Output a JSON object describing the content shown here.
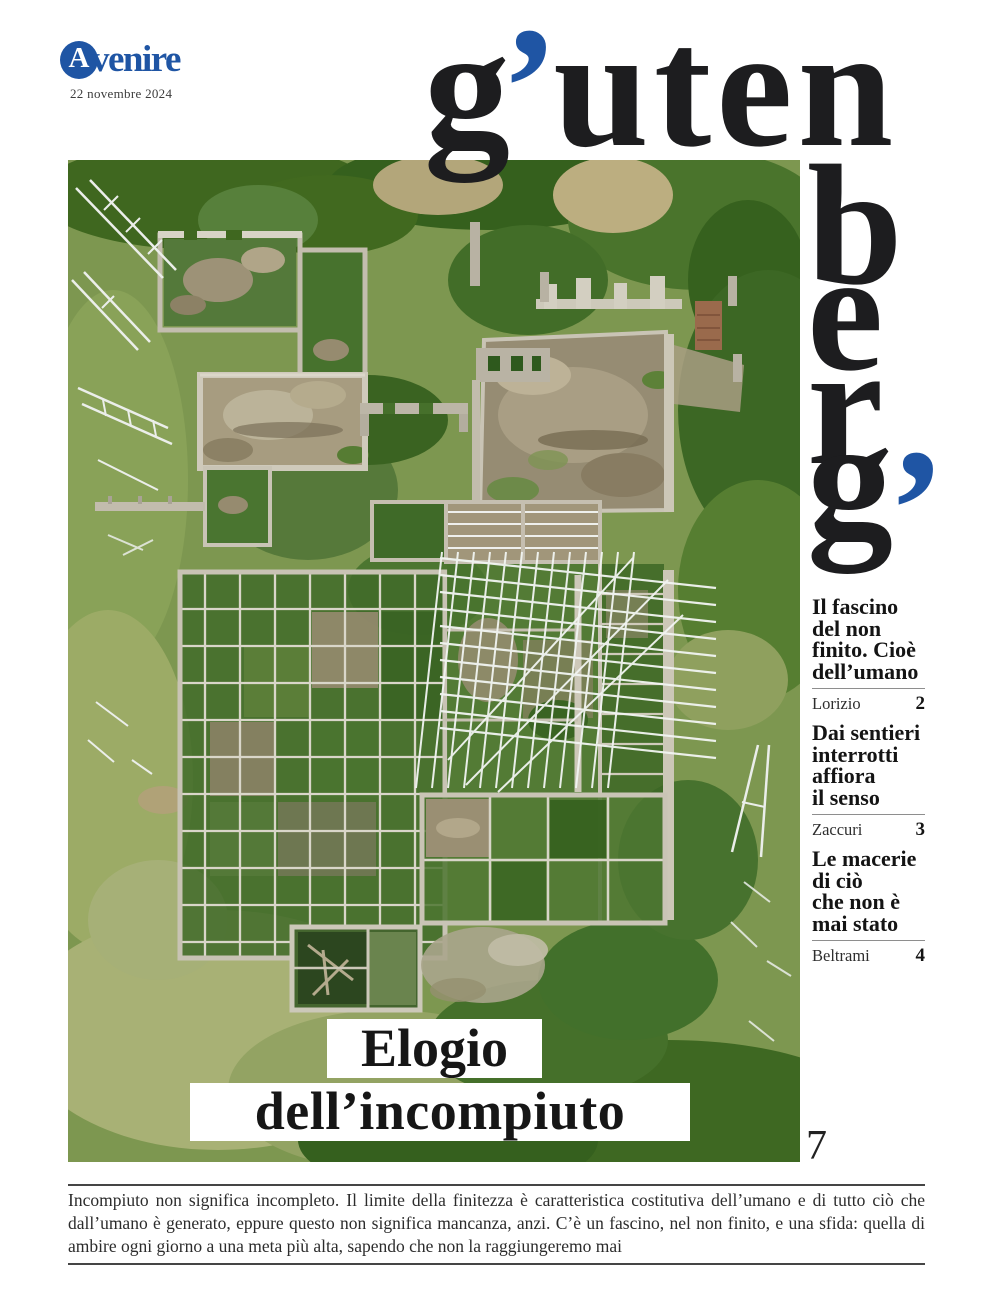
{
  "brand": {
    "name": "Avvenire",
    "initial": "A",
    "rest": "venire",
    "date": "22 novembre 2024"
  },
  "masthead": {
    "title": "gutenberg",
    "top_g": "g",
    "apostrophe": "’",
    "top_rest": "uten",
    "side_letters": [
      "b",
      "e",
      "r",
      "g"
    ],
    "side_apostrophe": "’"
  },
  "toc": {
    "items": [
      {
        "title": "Il fascino\ndel non\nfinito. Cioè\ndell’umano",
        "author": "Lorizio",
        "page": "2"
      },
      {
        "title": "Dai sentieri\ninterrotti\naffiora\nil senso",
        "author": "Zaccuri",
        "page": "3"
      },
      {
        "title": "Le macerie\ndi ciò\nche non è\nmai stato",
        "author": "Beltrami",
        "page": "4"
      }
    ]
  },
  "headline": {
    "line1": "Elogio",
    "line2": "dell’incompiuto"
  },
  "page_number": "7",
  "footer": {
    "text": "Incompiuto non significa incompleto. Il limite della finitezza è caratteristica costitutiva dell’umano e di tutto ciò che dall’umano è generato, eppure questo non significa mancanza, anzi. C’è un fascino, nel non finito, e una sfida: quella di ambire ogni giorno a una meta più alta, sapendo che non la raggiungeremo mai"
  },
  "colors": {
    "accent_blue": "#1f55a4",
    "ink": "#1d1d1f"
  }
}
